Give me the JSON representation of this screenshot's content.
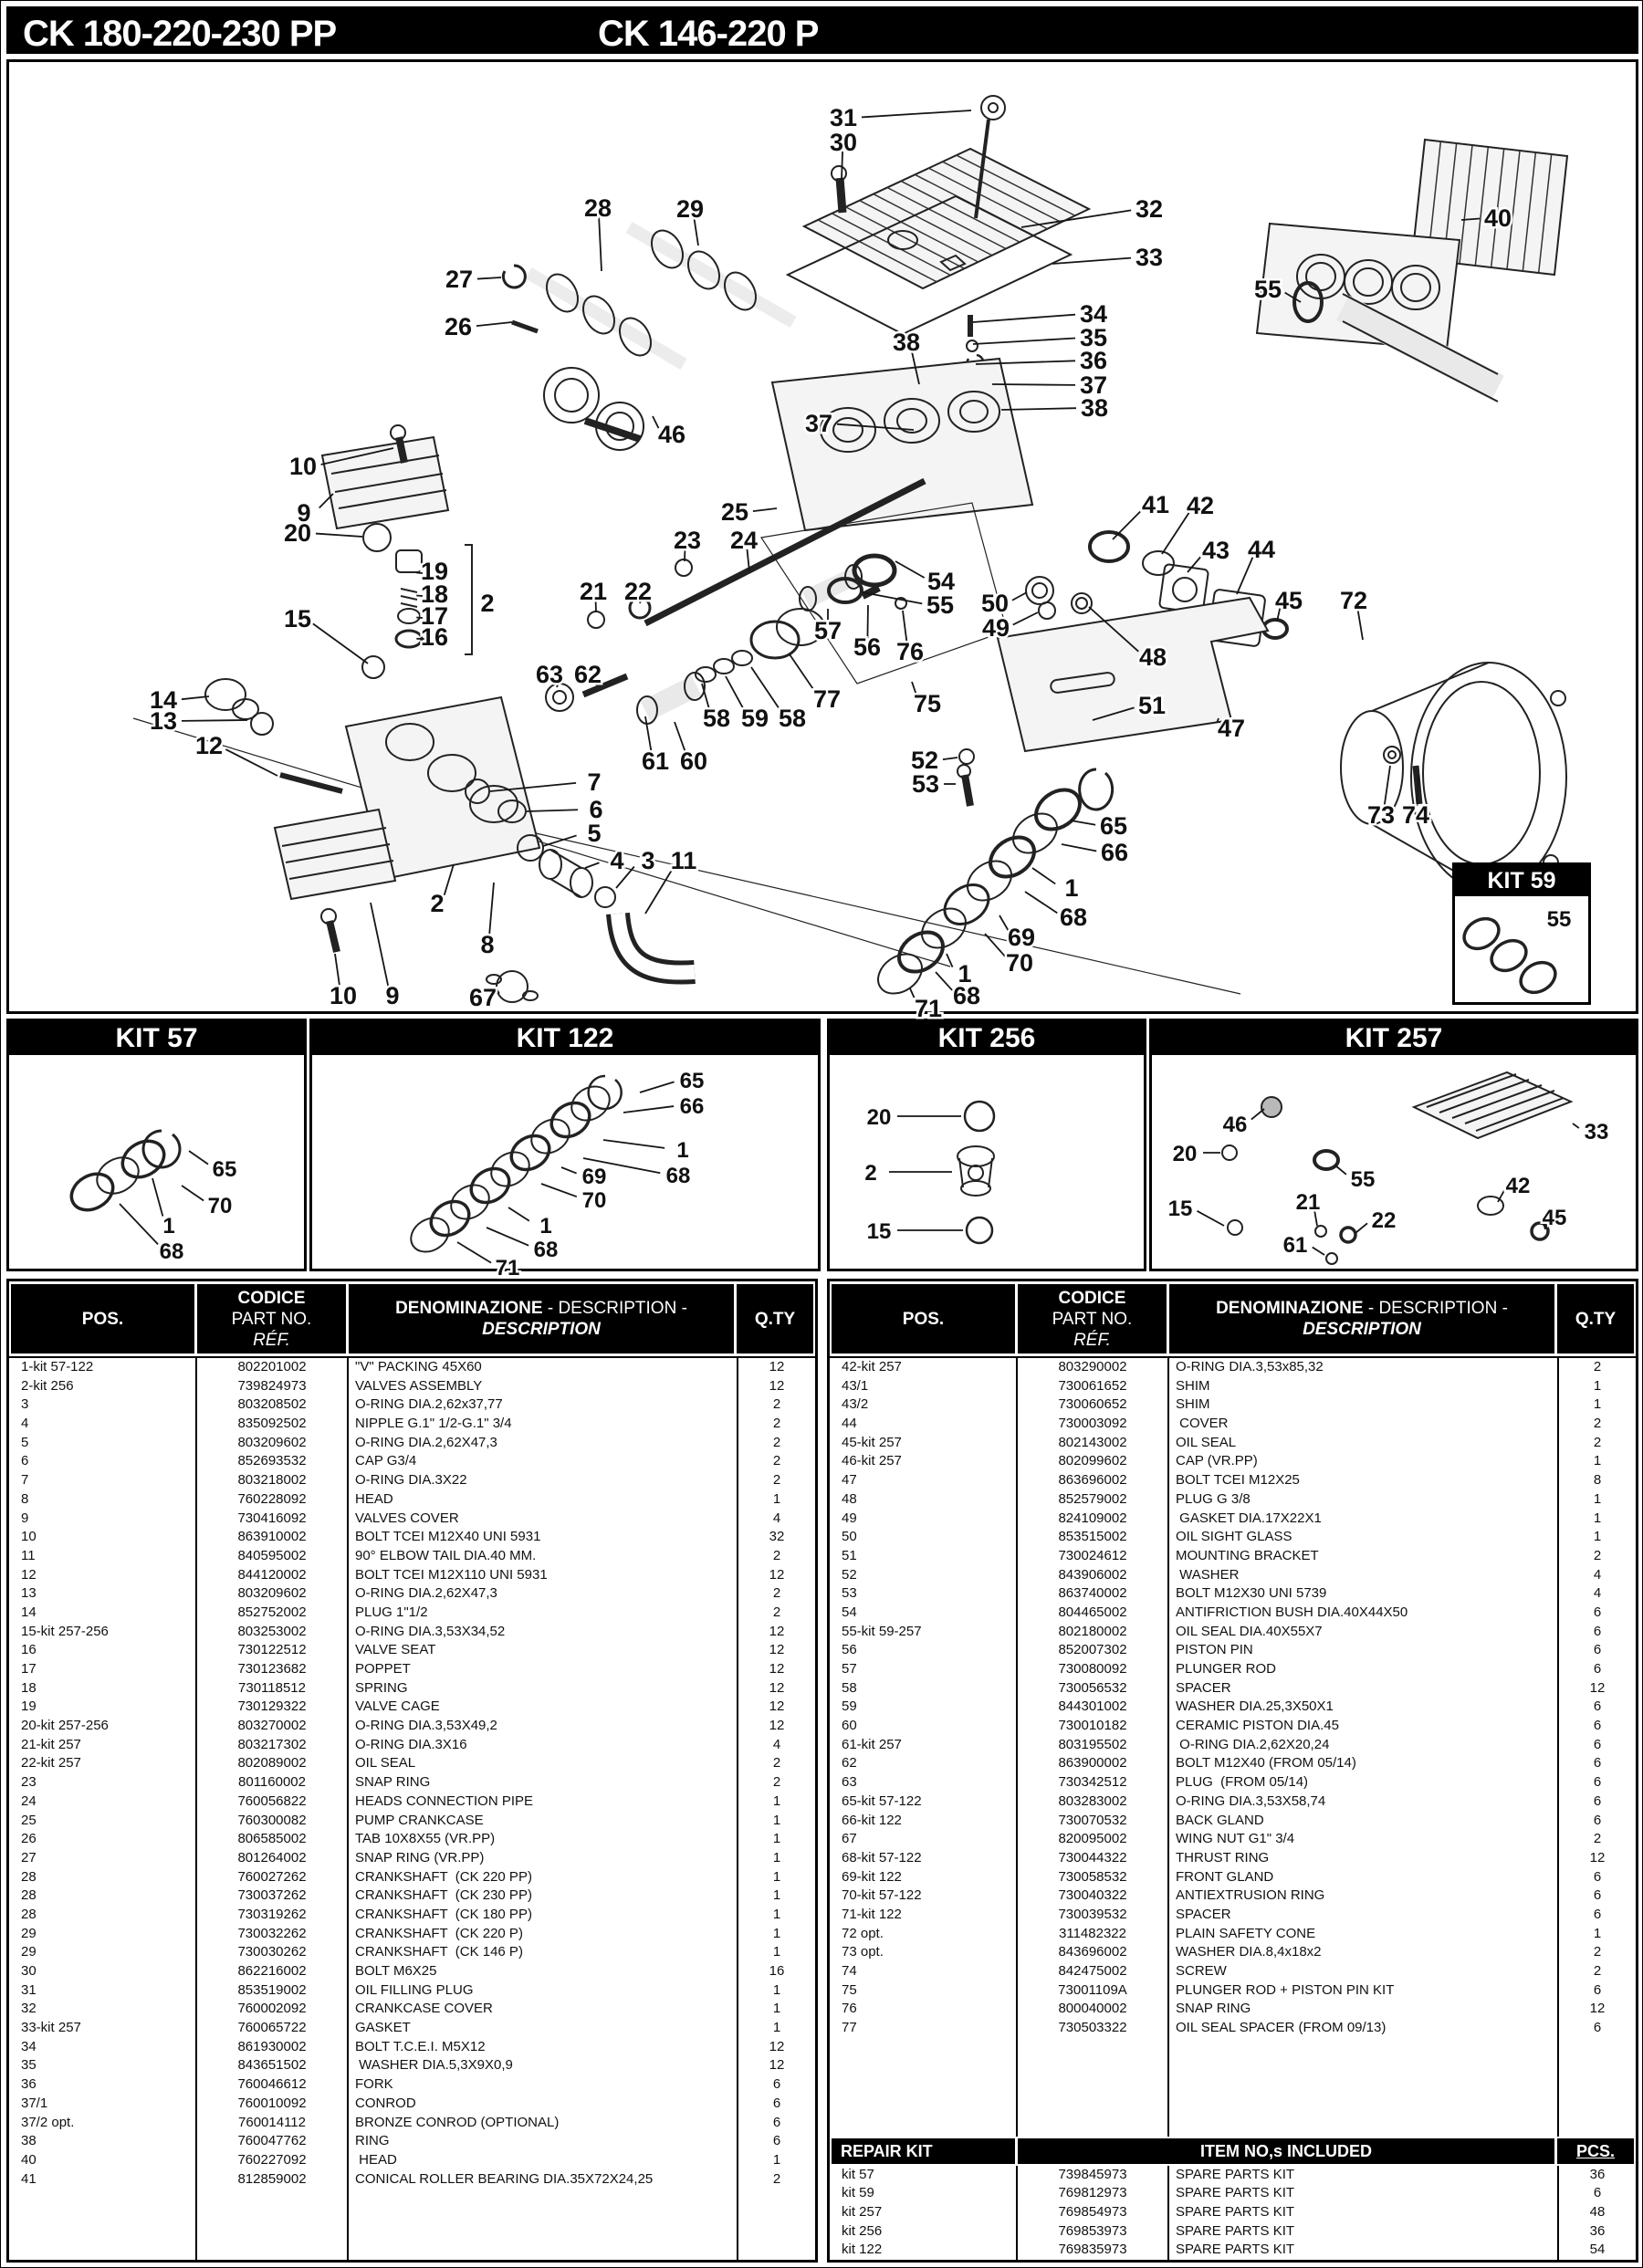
{
  "colors": {
    "ink": "#000000",
    "paper": "#ffffff"
  },
  "header": {
    "title_left": "CK 180-220-230 PP",
    "title_right": "CK 146-220 P"
  },
  "table_header": {
    "pos": "POS.",
    "code1": "CODICE",
    "code2": "PART NO.",
    "code3": "RÉF.",
    "den1": "DENOMINAZIONE",
    "den2": " - DESCRIPTION -",
    "den3": "DESCRIPTION",
    "qty": "Q.TY"
  },
  "diagram": {
    "callouts": [
      [
        "31",
        923,
        128,
        1063,
        120
      ],
      [
        "30",
        923,
        155,
        921,
        196
      ],
      [
        "28",
        654,
        227,
        658,
        296
      ],
      [
        "29",
        755,
        228,
        764,
        268
      ],
      [
        "27",
        502,
        305,
        548,
        303
      ],
      [
        "26",
        501,
        357,
        560,
        352
      ],
      [
        "46",
        735,
        475,
        714,
        455
      ],
      [
        "32",
        1258,
        228,
        1118,
        248
      ],
      [
        "33",
        1258,
        281,
        1152,
        288
      ],
      [
        "34",
        1197,
        343,
        1065,
        352
      ],
      [
        "35",
        1197,
        369,
        1065,
        376
      ],
      [
        "36",
        1197,
        394,
        1068,
        398
      ],
      [
        "37",
        1197,
        421,
        1086,
        420
      ],
      [
        "38",
        1198,
        446,
        1096,
        448
      ],
      [
        "38",
        992,
        374,
        1006,
        420
      ],
      [
        "37",
        896,
        463,
        1000,
        470
      ],
      [
        "40",
        1640,
        238,
        1600,
        240
      ],
      [
        "55",
        1388,
        316,
        1424,
        330
      ],
      [
        "25",
        804,
        560,
        850,
        556
      ],
      [
        "10",
        331,
        510,
        430,
        490
      ],
      [
        "9",
        332,
        561,
        364,
        540
      ],
      [
        "20",
        325,
        583,
        396,
        587
      ],
      [
        "19",
        475,
        625,
        462,
        627
      ],
      [
        "18",
        475,
        650,
        462,
        652
      ],
      [
        "17",
        475,
        674,
        462,
        676
      ],
      [
        "16",
        475,
        697,
        464,
        699
      ],
      [
        "2",
        533,
        660,
        null,
        null
      ],
      [
        "15",
        325,
        677,
        402,
        726
      ],
      [
        "14",
        178,
        766,
        228,
        762
      ],
      [
        "13",
        178,
        789,
        270,
        788
      ],
      [
        "12",
        228,
        816,
        303,
        849
      ],
      [
        "23",
        752,
        591,
        749,
        614
      ],
      [
        "24",
        814,
        591,
        820,
        625
      ],
      [
        "21",
        649,
        647,
        652,
        670
      ],
      [
        "22",
        698,
        647,
        700,
        660
      ],
      [
        "63",
        601,
        738,
        609,
        752
      ],
      [
        "62",
        643,
        738,
        652,
        750
      ],
      [
        "58",
        784,
        786,
        768,
        748
      ],
      [
        "59",
        826,
        786,
        794,
        740
      ],
      [
        "58",
        867,
        786,
        822,
        730
      ],
      [
        "61",
        717,
        833,
        706,
        784
      ],
      [
        "60",
        759,
        833,
        738,
        790
      ],
      [
        "77",
        905,
        765,
        864,
        716
      ],
      [
        "75",
        1015,
        770,
        998,
        746
      ],
      [
        "57",
        906,
        690,
        906,
        666
      ],
      [
        "56",
        949,
        708,
        950,
        662
      ],
      [
        "76",
        996,
        713,
        988,
        668
      ],
      [
        "54",
        1030,
        636,
        980,
        614
      ],
      [
        "55",
        1029,
        662,
        944,
        648
      ],
      [
        "41",
        1265,
        552,
        1218,
        590
      ],
      [
        "42",
        1314,
        553,
        1272,
        606
      ],
      [
        "43",
        1331,
        602,
        1300,
        626
      ],
      [
        "44",
        1381,
        601,
        1354,
        650
      ],
      [
        "45",
        1411,
        657,
        1398,
        680
      ],
      [
        "72",
        1482,
        657,
        1492,
        700
      ],
      [
        "50",
        1089,
        660,
        1124,
        648
      ],
      [
        "49",
        1090,
        687,
        1136,
        670
      ],
      [
        "48",
        1262,
        719,
        1192,
        664
      ],
      [
        "51",
        1261,
        772,
        1196,
        788
      ],
      [
        "47",
        1348,
        797,
        1334,
        786
      ],
      [
        "52",
        1012,
        832,
        1048,
        829
      ],
      [
        "53",
        1013,
        858,
        1046,
        858
      ],
      [
        "7",
        650,
        856,
        536,
        866
      ],
      [
        "6",
        652,
        886,
        576,
        888
      ],
      [
        "5",
        650,
        912,
        594,
        926
      ],
      [
        "4",
        675,
        942,
        640,
        950
      ],
      [
        "3",
        709,
        942,
        674,
        972
      ],
      [
        "11",
        748,
        942,
        706,
        1000
      ],
      [
        "2",
        478,
        989,
        496,
        946
      ],
      [
        "8",
        533,
        1034,
        540,
        966
      ],
      [
        "10",
        375,
        1090,
        366,
        1044
      ],
      [
        "9",
        429,
        1090,
        405,
        988
      ],
      [
        "67",
        528,
        1092,
        544,
        1084
      ],
      [
        "65",
        1219,
        904,
        1172,
        898
      ],
      [
        "66",
        1220,
        933,
        1162,
        924
      ],
      [
        "1",
        1173,
        972,
        1130,
        950
      ],
      [
        "68",
        1175,
        1004,
        1122,
        976
      ],
      [
        "69",
        1118,
        1026,
        1094,
        1002
      ],
      [
        "70",
        1116,
        1054,
        1078,
        1022
      ],
      [
        "1",
        1056,
        1066,
        1036,
        1044
      ],
      [
        "68",
        1058,
        1090,
        1024,
        1064
      ],
      [
        "71",
        1016,
        1104,
        996,
        1082
      ],
      [
        "73",
        1512,
        892,
        1522,
        838
      ],
      [
        "74",
        1550,
        892,
        1553,
        848
      ]
    ]
  },
  "kits": [
    {
      "title": "KIT 57",
      "callouts": [
        [
          "65",
          245,
          1279,
          206,
          1260
        ],
        [
          "70",
          240,
          1319,
          198,
          1298
        ],
        [
          "1",
          184,
          1341,
          166,
          1290
        ],
        [
          "68",
          187,
          1369,
          130,
          1318
        ]
      ]
    },
    {
      "title": "KIT 122",
      "callouts": [
        [
          "65",
          757,
          1182,
          700,
          1196
        ],
        [
          "66",
          757,
          1210,
          682,
          1218
        ],
        [
          "1",
          747,
          1258,
          660,
          1248
        ],
        [
          "68",
          742,
          1286,
          638,
          1268
        ],
        [
          "69",
          650,
          1287,
          614,
          1278
        ],
        [
          "70",
          650,
          1313,
          592,
          1296
        ],
        [
          "1",
          597,
          1341,
          556,
          1322
        ],
        [
          "68",
          597,
          1367,
          532,
          1344
        ],
        [
          "71",
          555,
          1387,
          500,
          1360
        ]
      ]
    },
    {
      "title": "KIT 256",
      "callouts": [
        [
          "20",
          962,
          1222,
          1052,
          1222
        ],
        [
          "2",
          953,
          1283,
          1042,
          1283
        ],
        [
          "15",
          962,
          1347,
          1054,
          1347
        ]
      ]
    },
    {
      "title": "KIT 257",
      "callouts": [
        [
          "46",
          1352,
          1230,
          1384,
          1214
        ],
        [
          "20",
          1297,
          1262,
          1336,
          1262
        ],
        [
          "55",
          1492,
          1290,
          1462,
          1276
        ],
        [
          "15",
          1292,
          1322,
          1340,
          1342
        ],
        [
          "21",
          1432,
          1315,
          1442,
          1342
        ],
        [
          "22",
          1515,
          1335,
          1484,
          1350
        ],
        [
          "61",
          1418,
          1362,
          1450,
          1374
        ],
        [
          "42",
          1662,
          1297,
          1640,
          1316
        ],
        [
          "45",
          1702,
          1332,
          1692,
          1346
        ],
        [
          "33",
          1748,
          1238,
          1722,
          1230
        ]
      ]
    },
    {
      "title": "KIT 59",
      "callouts": [
        [
          "55",
          1707,
          1005,
          null,
          null
        ]
      ]
    }
  ],
  "parts_left": [
    [
      "1-kit 57-122",
      "802201002",
      "\"V\" PACKING 45X60",
      "12"
    ],
    [
      "2-kit 256",
      "739824973",
      "VALVES ASSEMBLY",
      "12"
    ],
    [
      "3",
      "803208502",
      "O-RING DIA.2,62x37,77",
      "2"
    ],
    [
      "4",
      "835092502",
      "NIPPLE G.1\" 1/2-G.1\" 3/4",
      "2"
    ],
    [
      "5",
      "803209602",
      "O-RING DIA.2,62X47,3",
      "2"
    ],
    [
      "6",
      "852693532",
      "CAP G3/4",
      "2"
    ],
    [
      "7",
      "803218002",
      "O-RING DIA.3X22",
      "2"
    ],
    [
      "8",
      "760228092",
      "HEAD",
      "1"
    ],
    [
      "9",
      "730416092",
      "VALVES COVER",
      "4"
    ],
    [
      "10",
      "863910002",
      "BOLT TCEI M12X40 UNI 5931",
      "32"
    ],
    [
      "11",
      "840595002",
      "90° ELBOW TAIL DIA.40 MM.",
      "2"
    ],
    [
      "12",
      "844120002",
      "BOLT TCEI M12X110 UNI 5931",
      "12"
    ],
    [
      "13",
      "803209602",
      "O-RING DIA.2,62X47,3",
      "2"
    ],
    [
      "14",
      "852752002",
      "PLUG 1\"1/2",
      "2"
    ],
    [
      "15-kit 257-256",
      "803253002",
      "O-RING DIA.3,53X34,52",
      "12"
    ],
    [
      "16",
      "730122512",
      "VALVE SEAT",
      "12"
    ],
    [
      "17",
      "730123682",
      "POPPET",
      "12"
    ],
    [
      "18",
      "730118512",
      "SPRING",
      "12"
    ],
    [
      "19",
      "730129322",
      "VALVE CAGE",
      "12"
    ],
    [
      "20-kit 257-256",
      "803270002",
      "O-RING DIA.3,53X49,2",
      "12"
    ],
    [
      "21-kit 257",
      "803217302",
      "O-RING DIA.3X16",
      "4"
    ],
    [
      "22-kit 257",
      "802089002",
      "OIL SEAL",
      "2"
    ],
    [
      "23",
      "801160002",
      "SNAP RING",
      "2"
    ],
    [
      "24",
      "760056822",
      "HEADS CONNECTION PIPE",
      "1"
    ],
    [
      "25",
      "760300082",
      "PUMP CRANKCASE",
      "1"
    ],
    [
      "26",
      "806585002",
      "TAB 10X8X55 (VR.PP)",
      "1"
    ],
    [
      "27",
      "801264002",
      "SNAP RING (VR.PP)",
      "1"
    ],
    [
      "28",
      "760027262",
      "CRANKSHAFT  (CK 220 PP)",
      "1"
    ],
    [
      "28",
      "730037262",
      "CRANKSHAFT  (CK 230 PP)",
      "1"
    ],
    [
      "28",
      "730319262",
      "CRANKSHAFT  (CK 180 PP)",
      "1"
    ],
    [
      "29",
      "730032262",
      "CRANKSHAFT  (CK 220 P)",
      "1"
    ],
    [
      "29",
      "730030262",
      "CRANKSHAFT  (CK 146 P)",
      "1"
    ],
    [
      "30",
      "862216002",
      "BOLT M6X25",
      "16"
    ],
    [
      "31",
      "853519002",
      "OIL FILLING PLUG",
      "1"
    ],
    [
      "32",
      "760002092",
      "CRANKCASE COVER",
      "1"
    ],
    [
      "33-kit 257",
      "760065722",
      "GASKET",
      "1"
    ],
    [
      "34",
      "861930002",
      "BOLT T.C.E.I. M5X12",
      "12"
    ],
    [
      "35",
      "843651502",
      " WASHER DIA.5,3X9X0,9",
      "12"
    ],
    [
      "36",
      "760046612",
      "FORK",
      "6"
    ],
    [
      "37/1",
      "760010092",
      "CONROD",
      "6"
    ],
    [
      "37/2 opt.",
      "760014112",
      "BRONZE CONROD (OPTIONAL)",
      "6"
    ],
    [
      "38",
      "760047762",
      "RING",
      "6"
    ],
    [
      "40",
      "760227092",
      " HEAD",
      "1"
    ],
    [
      "41",
      "812859002",
      "CONICAL ROLLER BEARING DIA.35X72X24,25",
      "2"
    ]
  ],
  "parts_right": [
    [
      "42-kit 257",
      "803290002",
      "O-RING DIA.3,53x85,32",
      "2"
    ],
    [
      "43/1",
      "730061652",
      "SHIM",
      "1"
    ],
    [
      "43/2",
      "730060652",
      "SHIM",
      "1"
    ],
    [
      "44",
      "730003092",
      " COVER",
      "2"
    ],
    [
      "45-kit 257",
      "802143002",
      "OIL SEAL",
      "2"
    ],
    [
      "46-kit 257",
      "802099602",
      "CAP (VR.PP)",
      "1"
    ],
    [
      "47",
      "863696002",
      "BOLT TCEI M12X25",
      "8"
    ],
    [
      "48",
      "852579002",
      "PLUG G 3/8",
      "1"
    ],
    [
      "49",
      "824109002",
      " GASKET DIA.17X22X1",
      "1"
    ],
    [
      "50",
      "853515002",
      "OIL SIGHT GLASS",
      "1"
    ],
    [
      "51",
      "730024612",
      "MOUNTING BRACKET",
      "2"
    ],
    [
      "52",
      "843906002",
      " WASHER",
      "4"
    ],
    [
      "53",
      "863740002",
      "BOLT M12X30 UNI 5739",
      "4"
    ],
    [
      "54",
      "804465002",
      "ANTIFRICTION BUSH DIA.40X44X50",
      "6"
    ],
    [
      "55-kit 59-257",
      "802180002",
      "OIL SEAL DIA.40X55X7",
      "6"
    ],
    [
      "56",
      "852007302",
      "PISTON PIN",
      "6"
    ],
    [
      "57",
      "730080092",
      "PLUNGER ROD",
      "6"
    ],
    [
      "58",
      "730056532",
      "SPACER",
      "12"
    ],
    [
      "59",
      "844301002",
      "WASHER DIA.25,3X50X1",
      "6"
    ],
    [
      "60",
      "730010182",
      "CERAMIC PISTON DIA.45",
      "6"
    ],
    [
      "61-kit 257",
      "803195502",
      " O-RING DIA.2,62X20,24",
      "6"
    ],
    [
      "62",
      "863900002",
      "BOLT M12X40 (FROM 05/14)",
      "6"
    ],
    [
      "63",
      "730342512",
      "PLUG  (FROM 05/14)",
      "6"
    ],
    [
      "65-kit 57-122",
      "803283002",
      "O-RING DIA.3,53X58,74",
      "6"
    ],
    [
      "66-kit 122",
      "730070532",
      "BACK GLAND",
      "6"
    ],
    [
      "67",
      "820095002",
      "WING NUT G1\" 3/4",
      "2"
    ],
    [
      "68-kit 57-122",
      "730044322",
      "THRUST RING",
      "12"
    ],
    [
      "69-kit 122",
      "730058532",
      "FRONT GLAND",
      "6"
    ],
    [
      "70-kit 57-122",
      "730040322",
      "ANTIEXTRUSION RING",
      "6"
    ],
    [
      "71-kit 122",
      "730039532",
      "SPACER",
      "6"
    ],
    [
      "72 opt.",
      "311482322",
      "PLAIN SAFETY CONE",
      "1"
    ],
    [
      "73 opt.",
      "843696002",
      "WASHER DIA.8,4x18x2",
      "2"
    ],
    [
      "74",
      "842475002",
      "SCREW",
      "2"
    ],
    [
      "75",
      "73001109A",
      "PLUNGER ROD + PISTON PIN KIT",
      "6"
    ],
    [
      "76",
      "800040002",
      "SNAP RING",
      "12"
    ],
    [
      "77",
      "730503322",
      "OIL SEAL SPACER (FROM 09/13)",
      "6"
    ]
  ],
  "repair": {
    "title": "REPAIR KIT",
    "included": "ITEM  NO,s  INCLUDED",
    "pcs": "PCS.",
    "rows": [
      [
        "kit 57",
        "739845973",
        "SPARE PARTS KIT",
        "36"
      ],
      [
        "kit 59",
        "769812973",
        "SPARE PARTS KIT",
        "6"
      ],
      [
        "kit 257",
        "769854973",
        "SPARE PARTS KIT",
        "48"
      ],
      [
        "kit 256",
        "769853973",
        "SPARE PARTS KIT",
        "36"
      ],
      [
        "kit 122",
        "769835973",
        "SPARE PARTS KIT",
        "54"
      ]
    ]
  }
}
